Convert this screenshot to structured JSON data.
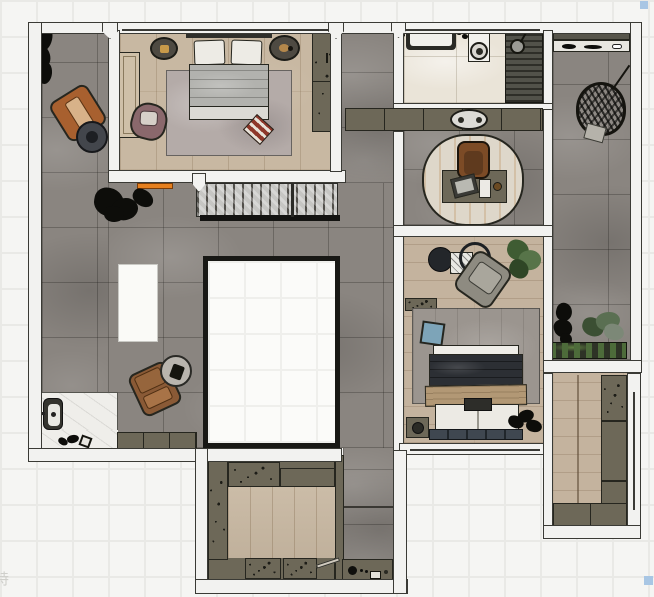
{
  "app": {
    "kind": "floor-plan-render-top-view",
    "watermark_text": "特"
  },
  "palette": {
    "bg": "#f5f5f3",
    "grid": "#e9e9e6",
    "wall": "#f2f2f0",
    "wall_outline": "#3a3a35",
    "stone": "#8a8580",
    "wood": "#c8b8a2",
    "wood2": "#c4b39e",
    "bath": "#eae4d8",
    "cab": "#6d6858",
    "stairs": "#c6c6c3",
    "rug_master": "#b4aba8",
    "rug_second": "#9b958f",
    "rug_office": "#ded7ca",
    "duvet_master": "#b2b2ae",
    "duvet_navy": "#2c2f34",
    "blanket_tan": "#b29875",
    "pillow_blue": "#7da4b8",
    "chair_orange": "#a8602f",
    "chair_brown": "#8a5a36",
    "chair_mauve": "#8a686c",
    "ottoman_red": "#8e372a",
    "accent_orange": "#e6801f",
    "plant_green": "#4d6b3a",
    "sel": "#a8c6e4"
  },
  "scene": {
    "rooms": [
      "terrace",
      "master-bedroom",
      "bathroom",
      "home-office",
      "dressing-sitting-area",
      "second-bedroom",
      "side-balcony",
      "walk-in-closet",
      "storage-kitchenette-room",
      "corridor"
    ],
    "objects": {
      "terrace": [
        "potted-plant",
        "orange-lounge-chair",
        "round-side-table",
        "shrub-plant",
        "brown-armchair",
        "round-side-table",
        "outdoor-basin",
        "garden-bench",
        "white-marble-pad",
        "orange-doormat",
        "staircase",
        "floor-void-opening",
        "white-island-skylight"
      ],
      "master-bedroom": [
        "double-bed",
        "pillows",
        "area-rug",
        "nightstand-left",
        "nightstand-right",
        "wardrobe",
        "wall-console",
        "mauve-armchair",
        "striped-ottoman"
      ],
      "bathroom": [
        "bathtub",
        "vanity-column",
        "toilet",
        "teak-shower-deck",
        "shower-head",
        "sink-cabinet-row",
        "oval-sink"
      ],
      "home-office": [
        "oval-rug",
        "desk",
        "office-chair",
        "laptop",
        "tablet",
        "bowl"
      ],
      "dressing-sitting-area": [
        "round-coffee-table",
        "wire-frame-table",
        "white-crate",
        "gray-lounge-chair",
        "potted-plant-green"
      ],
      "second-bedroom": [
        "double-bed",
        "navy-duvet",
        "tan-blanket",
        "blue-cushion",
        "area-rug",
        "nightstand",
        "dark-plant",
        "wardrobe-strip"
      ],
      "side-balcony": [
        "wall-shelf",
        "hanging-egg-chair",
        "dark-plant",
        "green-plant",
        "planter-box"
      ],
      "walk-in-closet": [
        "wood-walkway",
        "cabinet-column",
        "cabinet-row"
      ],
      "storage-kitchenette-room": [
        "cabinet-column",
        "upper-cabinets",
        "wood-floor",
        "bottom-cabinets",
        "utility-pole"
      ],
      "corridor": [
        "coffee-counter",
        "kettle",
        "small-box"
      ]
    },
    "selection_handles": [
      "top-right",
      "bottom-right"
    ]
  }
}
